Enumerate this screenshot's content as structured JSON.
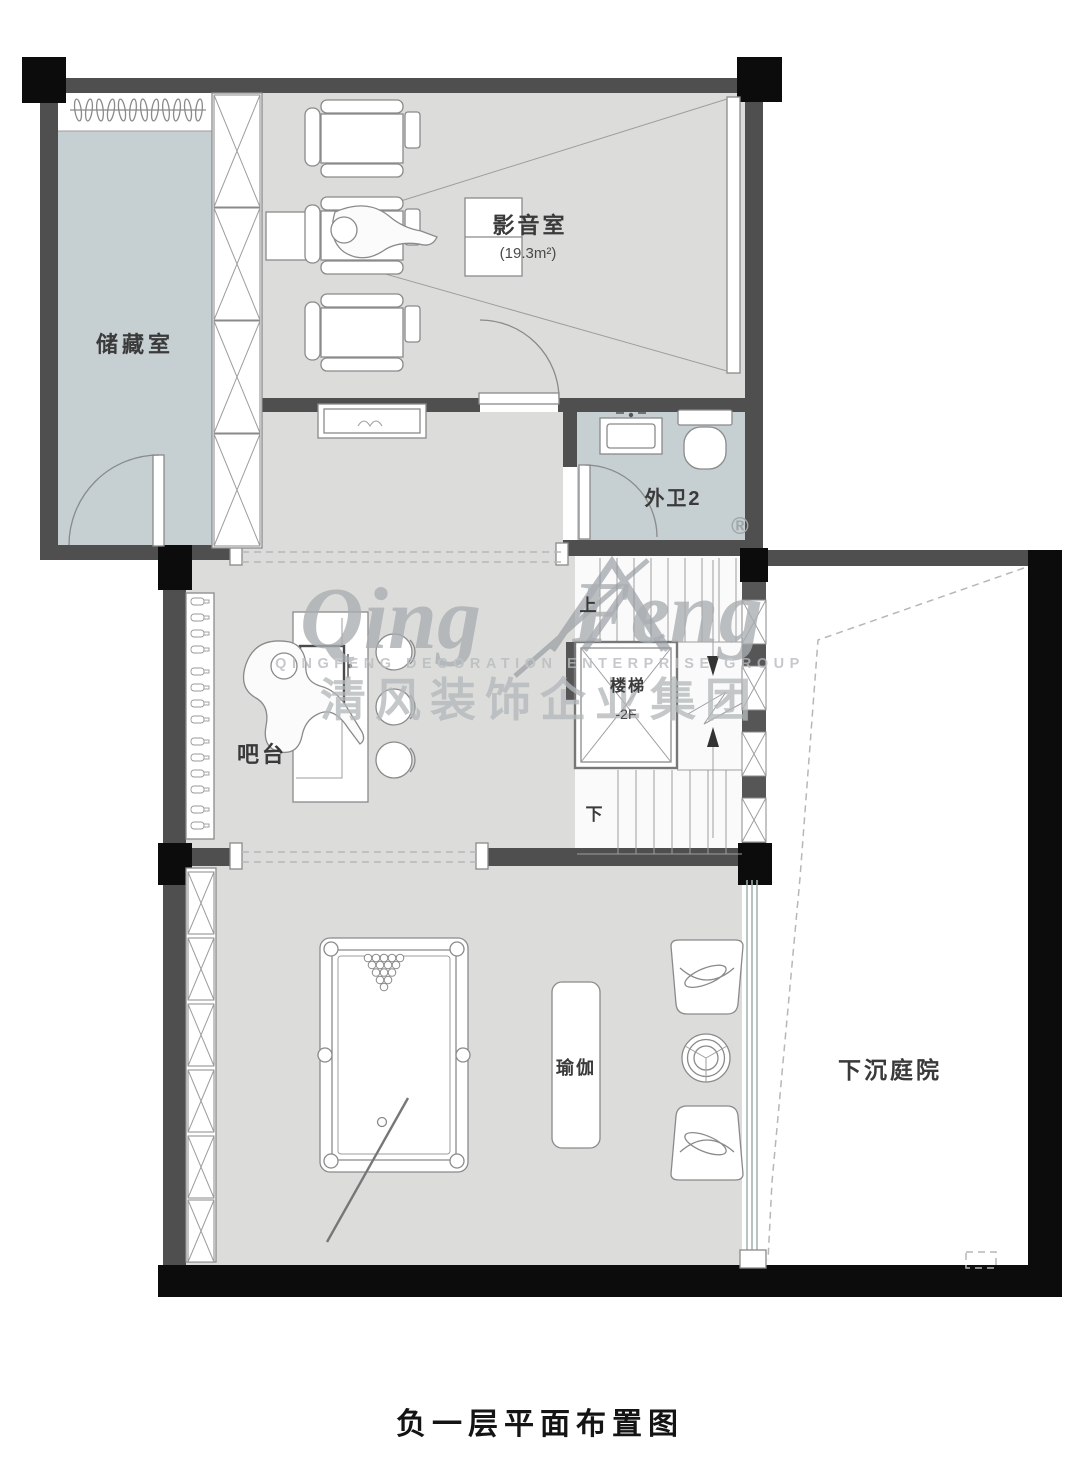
{
  "title": "负一层平面布置图",
  "watermark": {
    "script_left": "Qing",
    "script_right": "Feng",
    "caps": "QINGFENG  DECORATION  ENTERPRISE  GROUP",
    "cn": "清风装饰企业集团",
    "registered": "®"
  },
  "rooms": {
    "storage": {
      "label": "储藏室"
    },
    "cinema": {
      "label": "影音室",
      "area": "(19.3m²)"
    },
    "bath": {
      "label": "外卫2"
    },
    "bar": {
      "label": "吧台"
    },
    "stairs": {
      "label": "楼梯",
      "level": "-2F",
      "up": "上",
      "down": "下"
    },
    "yoga": {
      "label": "瑜伽"
    },
    "courtyard": {
      "label": "下沉庭院"
    }
  },
  "colors": {
    "wall_dark": "#4f4f4f",
    "wall_black": "#0c0c0c",
    "room_gray": "#dcdddb",
    "room_blue": "#c6cfd2",
    "furniture_line": "#8a8a8a",
    "watermark": "#b4b9bb"
  }
}
